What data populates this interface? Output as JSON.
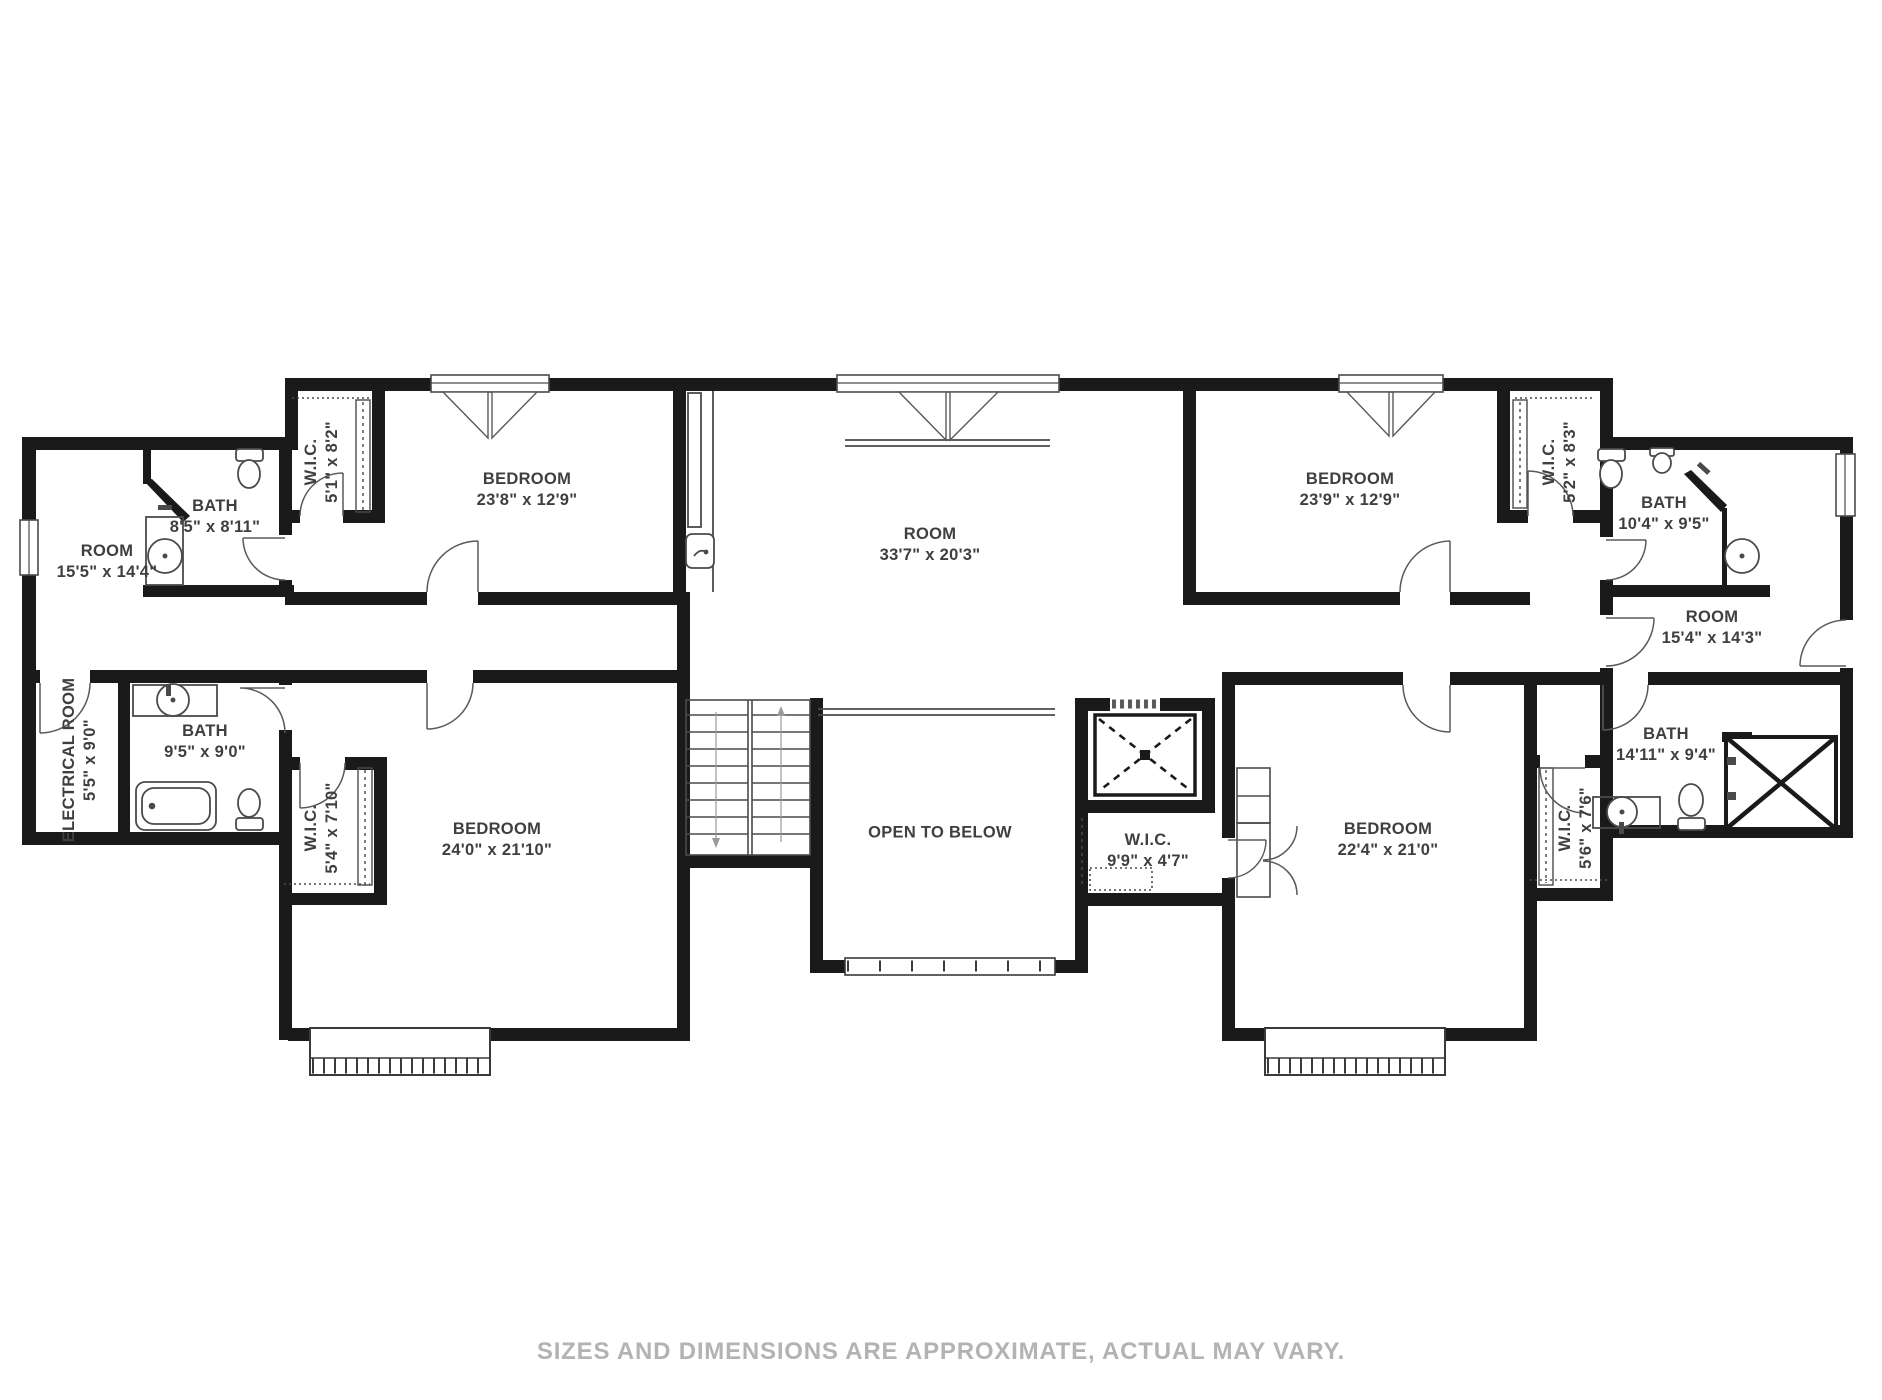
{
  "floorplan": {
    "disclaimer": "SIZES AND DIMENSIONS ARE APPROXIMATE, ACTUAL MAY VARY.",
    "colors": {
      "wall": "#1a1a1a",
      "thin_line": "#4a4a4a",
      "label_text": "#3f3f3f",
      "disclaimer_text": "#b3b3b3",
      "background": "#ffffff"
    },
    "rooms": [
      {
        "name": "ROOM",
        "dims": "15'5\" x 14'4\""
      },
      {
        "name": "BATH",
        "dims": "8'5\" x 8'11\""
      },
      {
        "name": "W.I.C.",
        "dims": "5'1\" x 8'2\""
      },
      {
        "name": "BEDROOM",
        "dims": "23'8\" x 12'9\""
      },
      {
        "name": "ROOM",
        "dims": "33'7\" x 20'3\""
      },
      {
        "name": "BEDROOM",
        "dims": "23'9\" x 12'9\""
      },
      {
        "name": "W.I.C.",
        "dims": "5'2\" x 8'3\""
      },
      {
        "name": "BATH",
        "dims": "10'4\" x 9'5\""
      },
      {
        "name": "ROOM",
        "dims": "15'4\" x 14'3\""
      },
      {
        "name": "ELECTRICAL ROOM",
        "dims": "5'5\" x 9'0\""
      },
      {
        "name": "BATH",
        "dims": "9'5\" x 9'0\""
      },
      {
        "name": "W.I.C.",
        "dims": "5'4\" x 7'10\""
      },
      {
        "name": "BEDROOM",
        "dims": "24'0\" x 21'10\""
      },
      {
        "name": "OPEN TO BELOW",
        "dims": ""
      },
      {
        "name": "W.I.C.",
        "dims": "9'9\" x 4'7\""
      },
      {
        "name": "BEDROOM",
        "dims": "22'4\" x 21'0\""
      },
      {
        "name": "W.I.C.",
        "dims": "5'6\" x 7'6\""
      },
      {
        "name": "BATH",
        "dims": "14'11\" x 9'4\""
      }
    ]
  }
}
